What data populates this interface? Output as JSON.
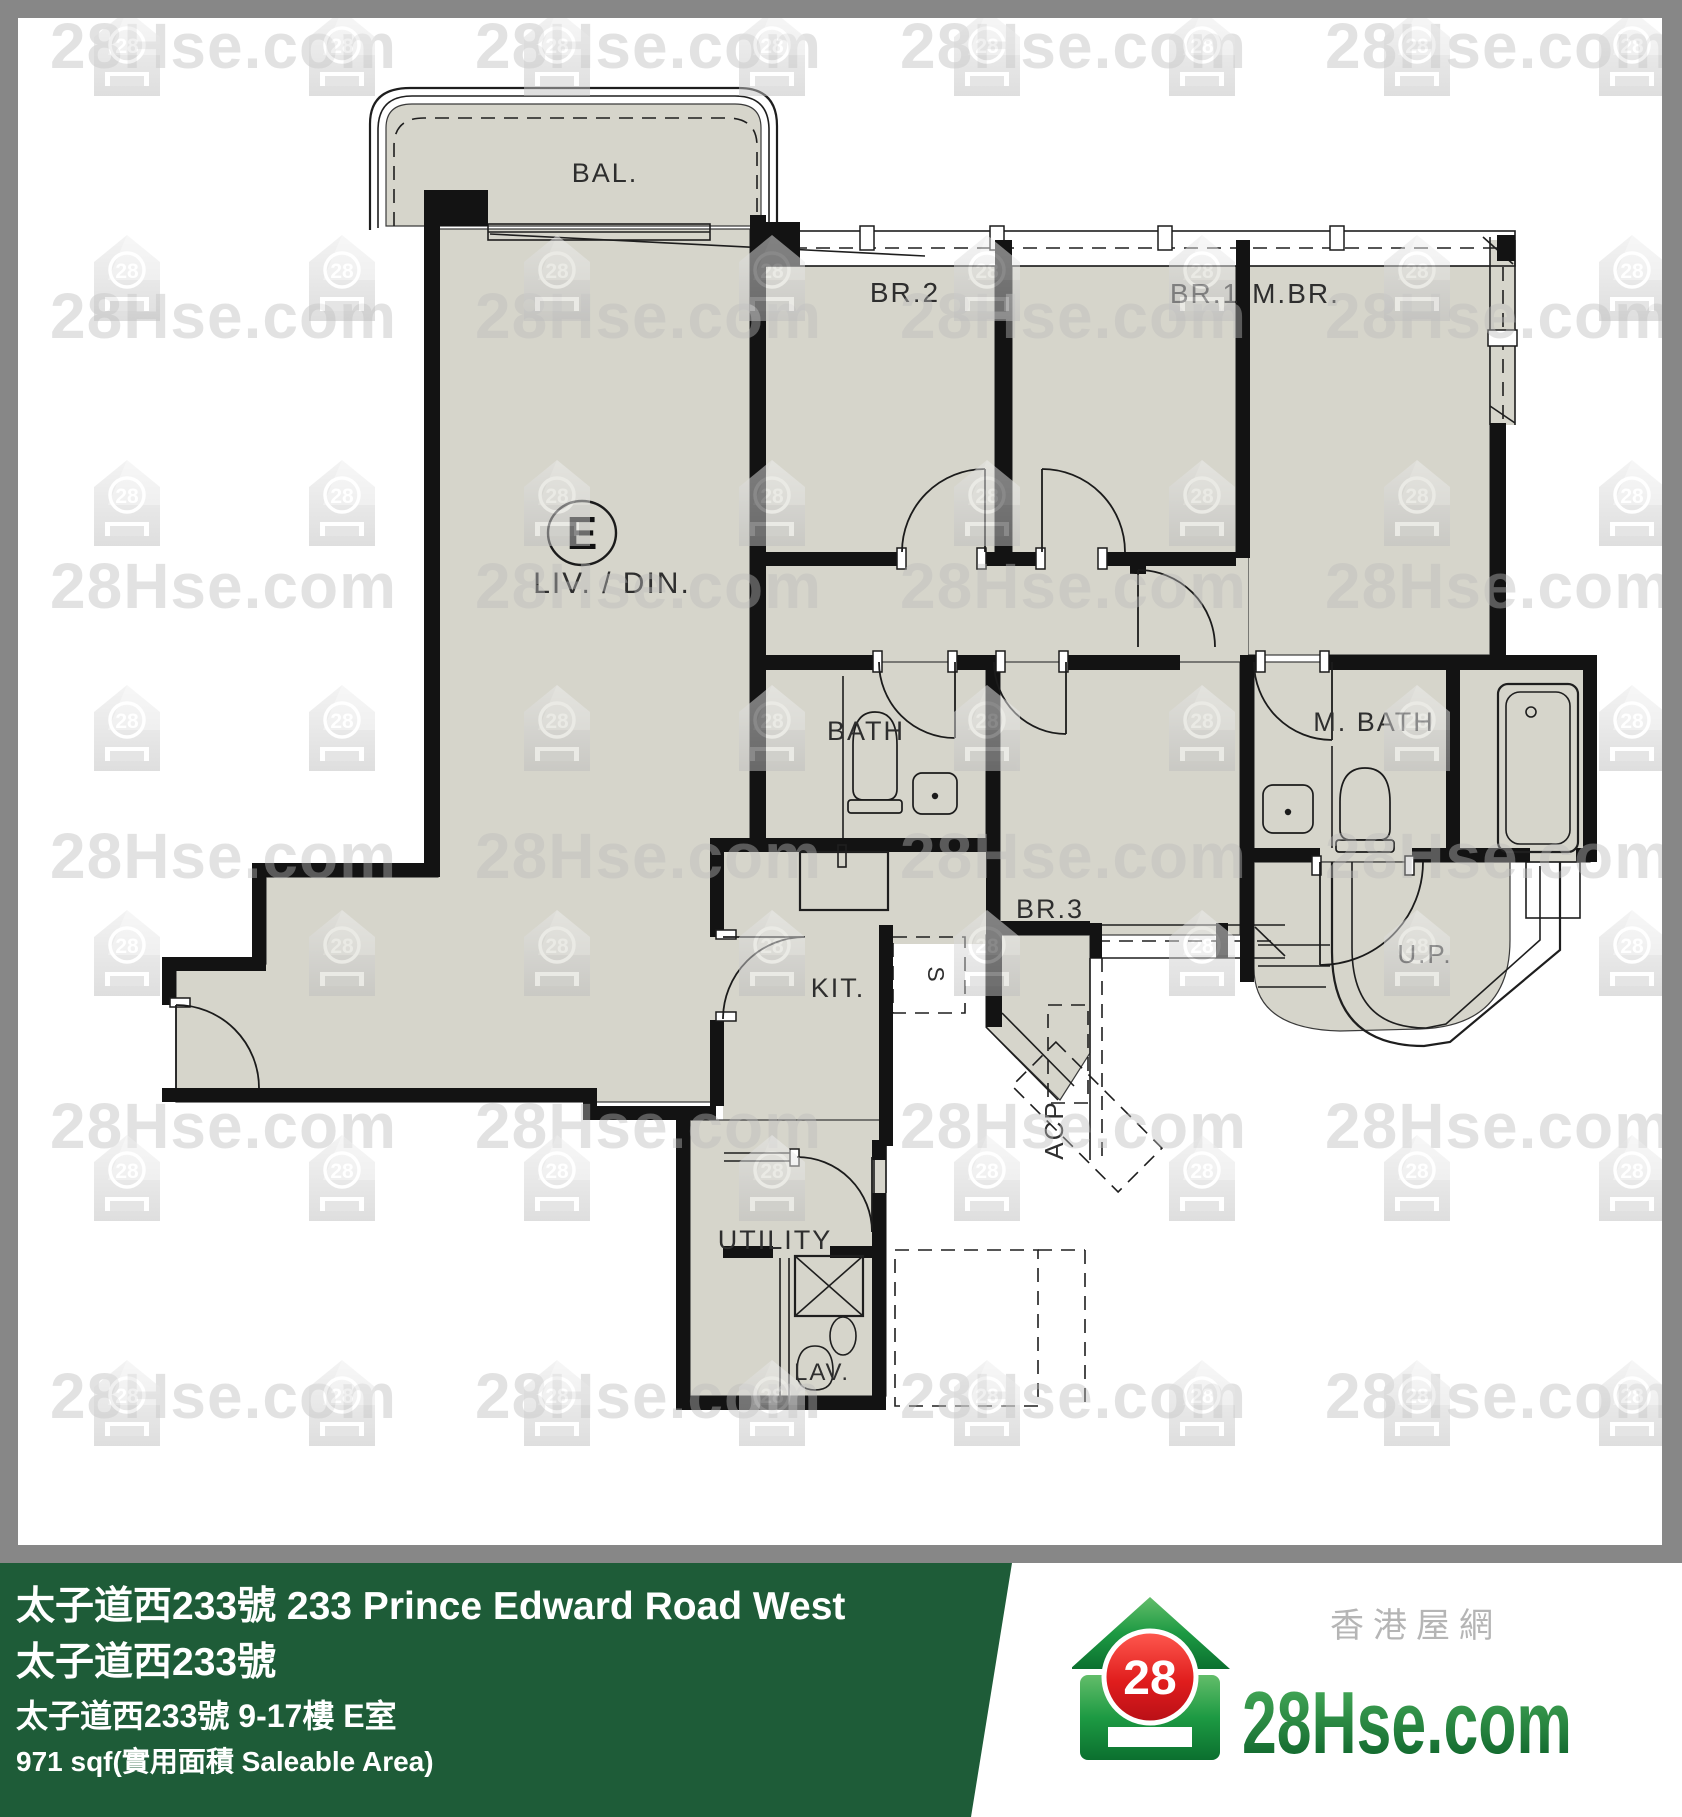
{
  "watermark": {
    "text": "28Hse.com",
    "badge": "28"
  },
  "plan": {
    "labels": {
      "bal": "BAL.",
      "br2": "BR.2",
      "br1": "BR.1",
      "mbr": "M.BR.",
      "unit": "E",
      "livdin": "LIV. / DIN.",
      "bath": "BATH",
      "mbath": "M. BATH",
      "br3": "BR.3",
      "kit": "KIT.",
      "s": "S",
      "utility": "UTILITY",
      "lav": "LAV.",
      "up": "U.P.",
      "acp": "ACP"
    }
  },
  "banner": {
    "line1": "太子道西233號 233  Prince Edward Road West",
    "line2": "太子道西233號",
    "line3": "太子道西233號 9-17樓 E室",
    "line4": "971 sqf(實用面積 Saleable Area)",
    "bg_color": "#1e5c38",
    "text_color": "#ffffff"
  },
  "logo": {
    "brand": "28Hse.com",
    "badge": "28",
    "tagline": "香港屋網",
    "green": "#1e8a3c",
    "red": "#d6171f"
  },
  "colors": {
    "floor": "#d6d5cb",
    "wall": "#131313",
    "border_gray": "#878787",
    "watermark_gray": "#bcbcbc"
  }
}
